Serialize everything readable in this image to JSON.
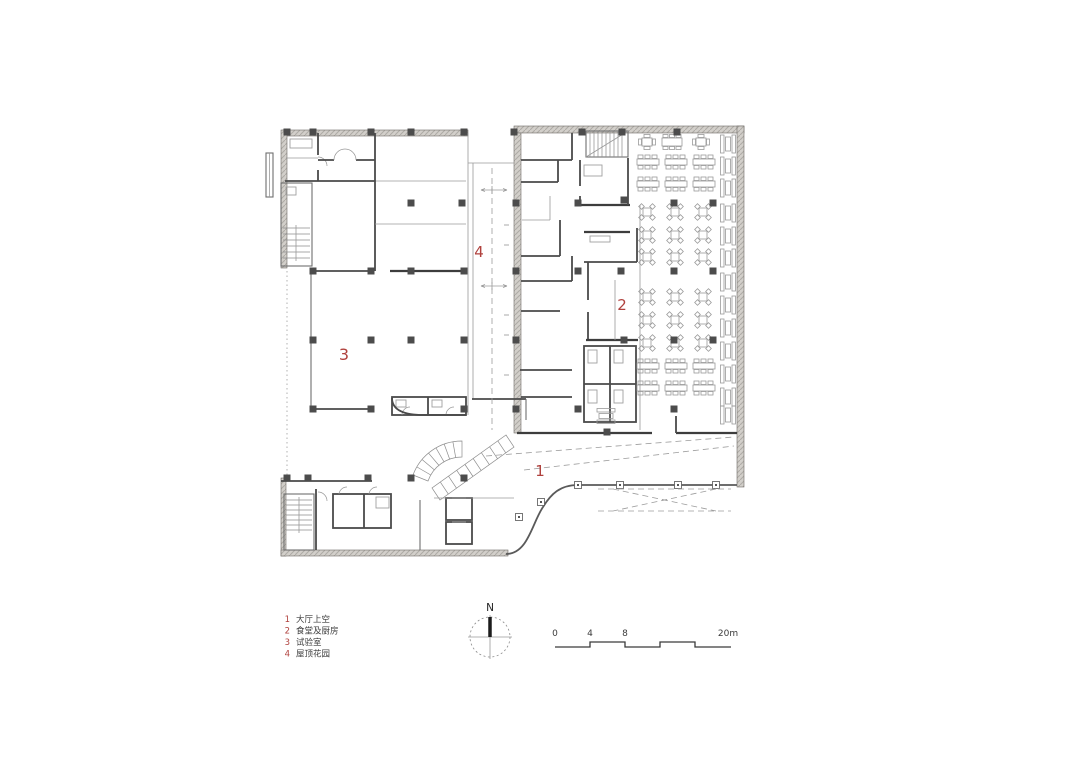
{
  "plan": {
    "markers": [
      {
        "text": "1"
      },
      {
        "text": "2"
      },
      {
        "text": "3"
      },
      {
        "text": "4"
      }
    ]
  },
  "legend": {
    "items": [
      {
        "num": "1",
        "label": "大厅上空"
      },
      {
        "num": "2",
        "label": "食堂及厨房"
      },
      {
        "num": "3",
        "label": "试验室"
      },
      {
        "num": "4",
        "label": "屋顶花园"
      }
    ]
  },
  "compass": {
    "north_label": "N"
  },
  "scale_bar": {
    "ticks": [
      {
        "t": "0"
      },
      {
        "t": "4"
      },
      {
        "t": "8"
      },
      {
        "t": "20m"
      }
    ]
  },
  "colors": {
    "marker_red": "#b0413d",
    "legend_red": "#b0413d",
    "line_dark": "#4a4a4a",
    "wall_fill": "#d2cfca"
  }
}
